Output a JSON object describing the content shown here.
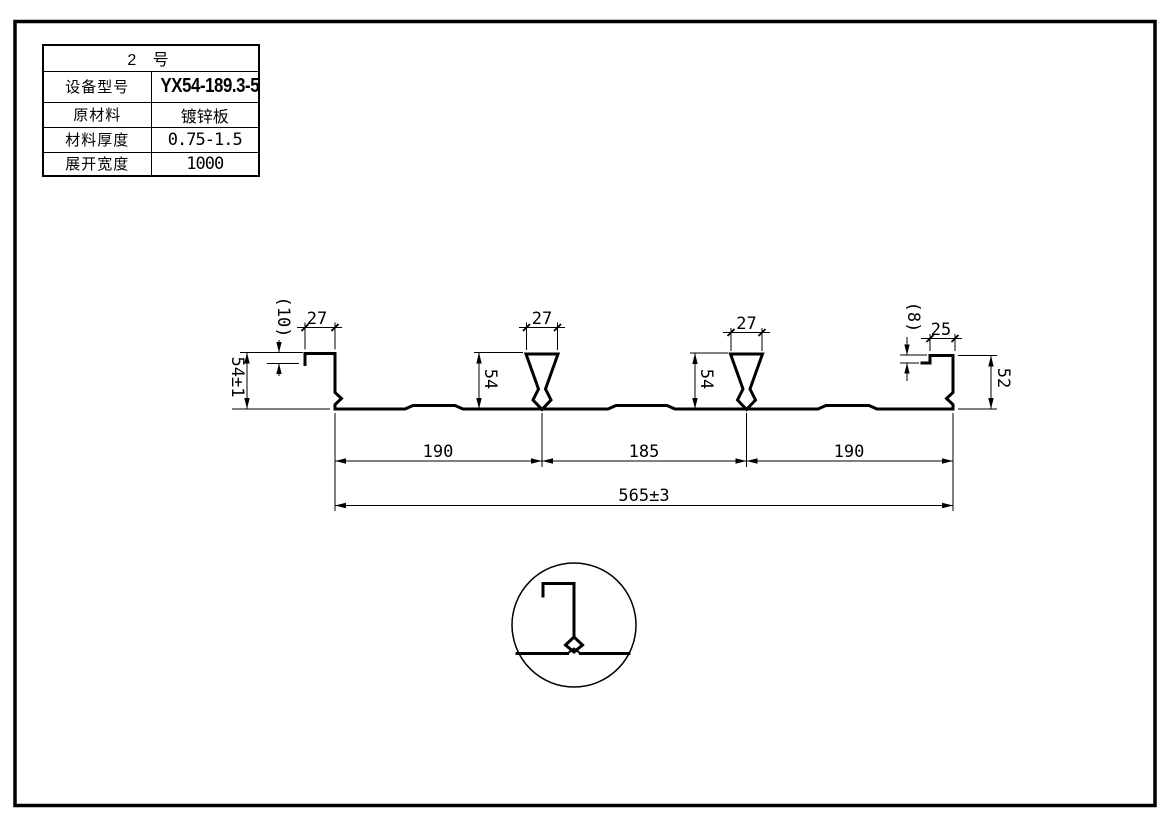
{
  "title_block": {
    "header": "2 号",
    "rows": [
      {
        "label": "设备型号",
        "value": "YX54-189.3-568"
      },
      {
        "label": "原材料",
        "value": "镀锌板"
      },
      {
        "label": "材料厚度",
        "value": "0.75-1.5"
      },
      {
        "label": "展开宽度",
        "value": "1000"
      }
    ]
  },
  "dimensions": {
    "left_hook_width": "27",
    "left_hook_drop": "(10)",
    "left_height": "54±1",
    "rib1_width": "27",
    "rib1_height": "54",
    "rib2_width": "27",
    "rib2_height": "54",
    "right_hook_drop": "(8)",
    "right_hook_width": "25",
    "right_height": "52",
    "span_left": "190",
    "span_middle": "185",
    "span_right": "190",
    "overall_width": "565±3"
  },
  "colors": {
    "line": "#000000",
    "background": "#ffffff"
  }
}
